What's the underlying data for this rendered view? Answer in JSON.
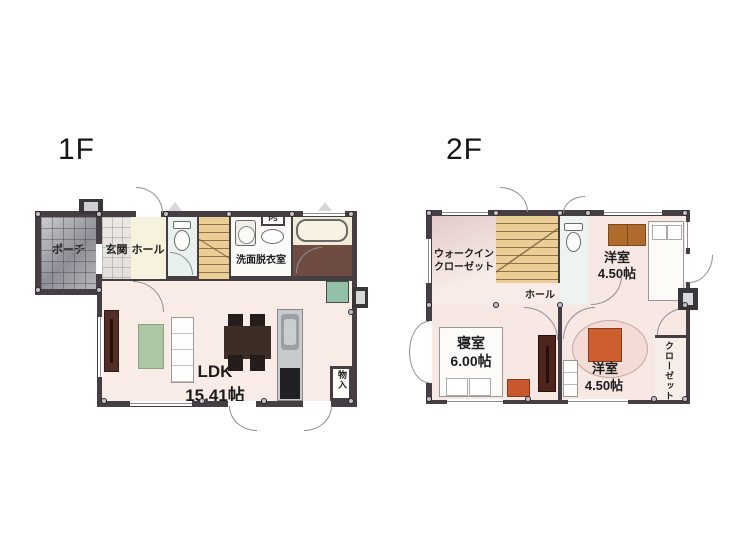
{
  "floors": {
    "f1": {
      "title": "1F",
      "labels": {
        "porch": "ポーチ",
        "genkan": "玄関",
        "hall": "ホール",
        "storage_top": "物入",
        "stairs": "UP",
        "ps": "PS",
        "washroom": "洗面脱衣室",
        "ldk_name": "LDK",
        "ldk_area": "15.41帖",
        "storage_side": "物入"
      }
    },
    "f2": {
      "title": "2F",
      "labels": {
        "wic_line1": "ウォークイン",
        "wic_line2": "クローゼット",
        "stairs": "DN",
        "hall": "ホール",
        "west_room_top_name": "洋室",
        "west_room_top_area": "4.50帖",
        "bedroom_name": "寝室",
        "bedroom_area": "6.00帖",
        "west_room_bottom_name": "洋室",
        "west_room_bottom_area": "4.50帖",
        "closet": "クローゼット"
      }
    }
  },
  "colors": {
    "wall": "#453e43",
    "ldk_floor": "#f9ebe5",
    "room_pink": "#f8e8e4",
    "hall_cream": "#f7f2de",
    "stairs_tan": "#eccd96",
    "bath_floor": "#6e4c42",
    "rug_green": "#adc6a4",
    "fridge_green": "#92c1a8",
    "accent_orange": "#cd5f2e"
  }
}
